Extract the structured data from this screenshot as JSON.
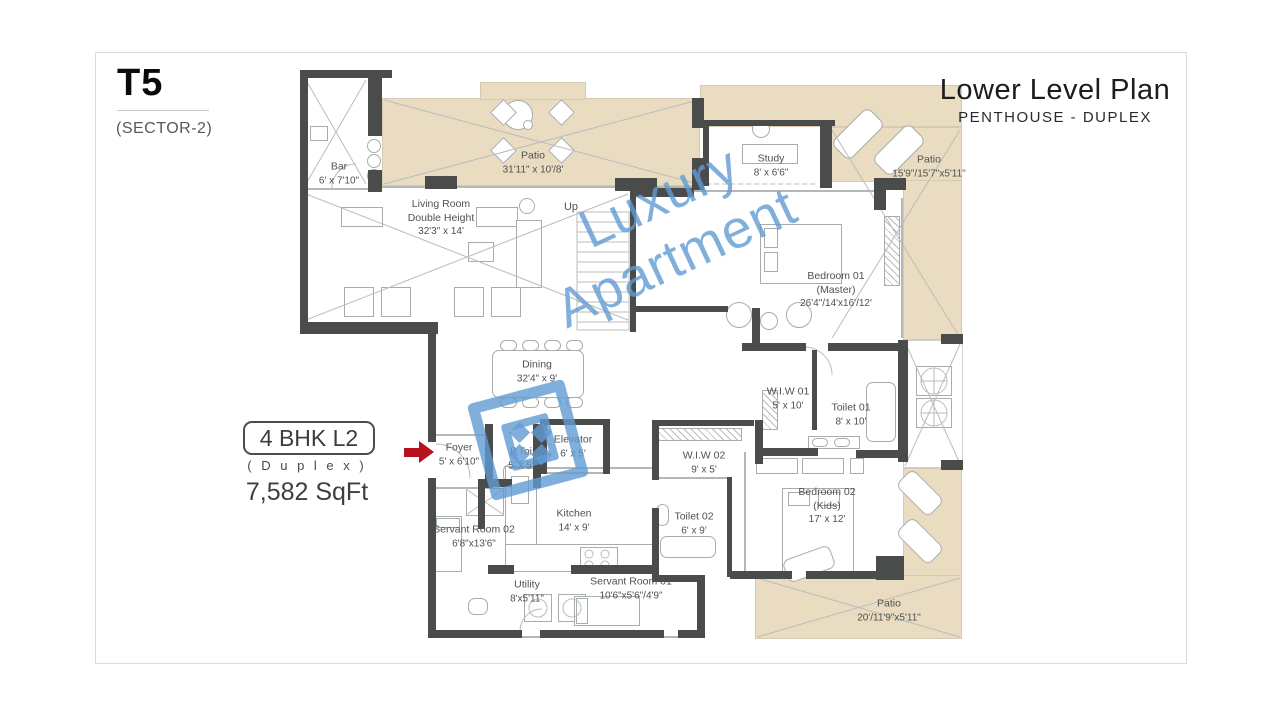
{
  "header": {
    "unit": "T5",
    "sector": "(SECTOR-2)",
    "title": "Lower Level Plan",
    "subtitle": "PENTHOUSE - DUPLEX"
  },
  "unit_info": {
    "badge": "4 BHK L2",
    "type": "( D u p l e x )",
    "area": "7,582 SqFt"
  },
  "watermark": {
    "line1": "Luxury",
    "line2": "Apartment"
  },
  "stairs": {
    "up": "Up"
  },
  "colors": {
    "wall": "#4a4c4c",
    "patio": "#eadcc0",
    "watermark_blue": "#5b9bd5",
    "entry_arrow_red": "#b5121b"
  },
  "rooms": [
    {
      "id": "bar",
      "name": "Bar",
      "dims": "6' x 7'10\""
    },
    {
      "id": "patio-top",
      "name": "Patio",
      "dims": "31'11\" x 10'/8'"
    },
    {
      "id": "study",
      "name": "Study",
      "dims": "8' x 6'6\""
    },
    {
      "id": "patio-right",
      "name": "Patio",
      "dims": "15'9\"/15'7\"x5'11\""
    },
    {
      "id": "living-room",
      "name": "Living Room",
      "name2": "Double Height",
      "dims": "32'3\" x 14'"
    },
    {
      "id": "bedroom-01",
      "name": "Bedroom 01",
      "name2": "(Master)",
      "dims": "26'4\"/14'x16'/12'"
    },
    {
      "id": "dining",
      "name": "Dining",
      "dims": "32'4\" x 9'"
    },
    {
      "id": "wiw-01",
      "name": "W.I.W 01",
      "dims": "5' x 10'"
    },
    {
      "id": "toilet-01",
      "name": "Toilet 01",
      "dims": "8' x 10'"
    },
    {
      "id": "foyer",
      "name": "Foyer",
      "dims": "5' x 6'10\""
    },
    {
      "id": "p-toi",
      "name": "P.Toi",
      "dims": "5' x 5'"
    },
    {
      "id": "elevator",
      "name": "Elevator",
      "dims": "6' x 5'"
    },
    {
      "id": "wiw-02",
      "name": "W.I.W 02",
      "dims": "9' x 5'"
    },
    {
      "id": "toilet-02",
      "name": "Toilet 02",
      "dims": "6' x 9'"
    },
    {
      "id": "bedroom-02",
      "name": "Bedroom 02",
      "name2": "(Kids)",
      "dims": "17' x 12'"
    },
    {
      "id": "servant-room-02",
      "name": "Servant Room 02",
      "dims": "6'8\"x13'6\""
    },
    {
      "id": "kitchen",
      "name": "Kitchen",
      "dims": "14' x 9'"
    },
    {
      "id": "utility",
      "name": "Utility",
      "dims": "8'x5'11\""
    },
    {
      "id": "servant-room-01",
      "name": "Servant Room 01",
      "dims": "10'6\"x5'6\"/4'9\""
    },
    {
      "id": "patio-bottom",
      "name": "Patio",
      "dims": "20'/11'9\"x5'11\""
    }
  ]
}
